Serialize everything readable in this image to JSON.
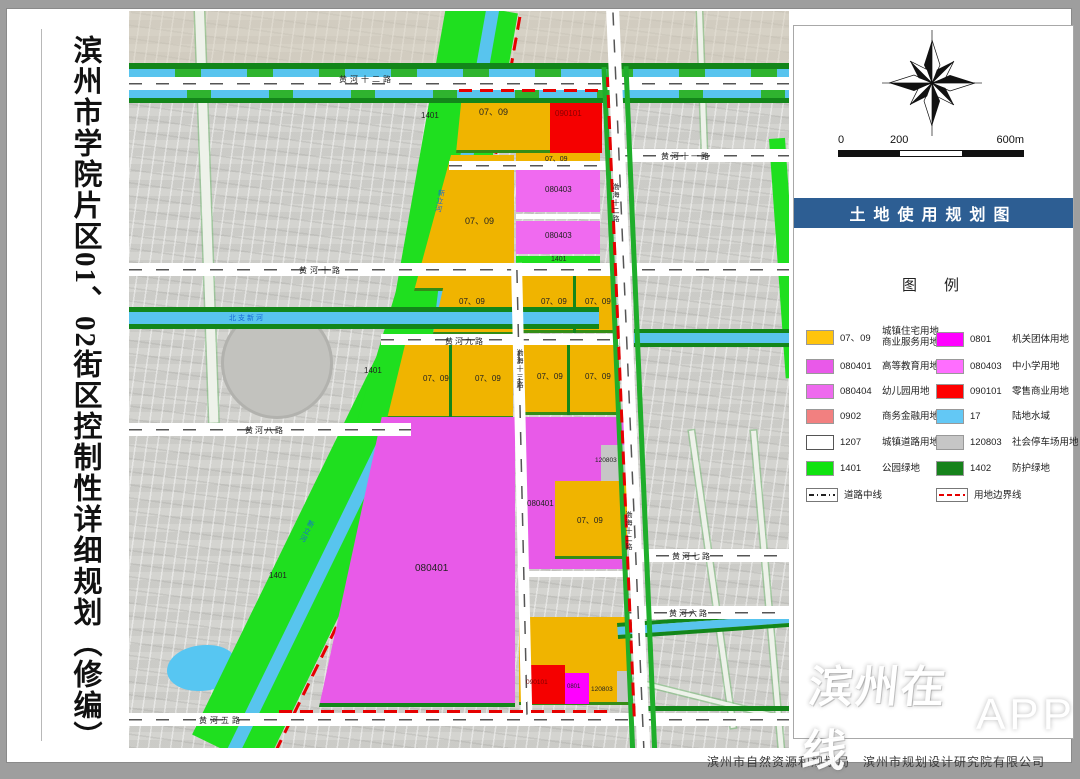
{
  "title": {
    "text": "滨州市学院片区01、02街区控制性详细规划（修编）"
  },
  "map": {
    "codes": {
      "res": "07、09",
      "gov": "0801",
      "edu": "080401",
      "school": "080403",
      "retail": "090101",
      "parking": "120803",
      "park": "1401"
    },
    "roads": {
      "hh12": "黄河十二路",
      "hh11": "黄河十一路",
      "hh10": "黄河十路",
      "hh9": "黄河九路",
      "hh8": "黄河八路",
      "hh7": "黄河七路",
      "hh6": "黄河六路",
      "hh5": "黄河五路",
      "bh12": "渤海十二路",
      "bh13": "渤海十三路"
    },
    "waters": {
      "canal": "新立河",
      "river": "北支新河"
    }
  },
  "panel": {
    "scale": {
      "t0": "0",
      "t200": "200",
      "t600": "600m"
    },
    "banner": {
      "text": "土地使用规划图",
      "color": "#2D5E93"
    },
    "legend_title": "图　例",
    "legend": [
      {
        "code": "07、09",
        "name": "城镇住宅用地",
        "name2": "商业服务用地",
        "color": "#FFC40C"
      },
      {
        "code": "0801",
        "name": "机关团体用地",
        "color": "#FF00FF"
      },
      {
        "code": "080401",
        "name": "高等教育用地",
        "color": "#E959E9"
      },
      {
        "code": "080403",
        "name": "中小学用地",
        "color": "#FF6EFF"
      },
      {
        "code": "080404",
        "name": "幼儿园用地",
        "color": "#EE6AEE"
      },
      {
        "code": "090101",
        "name": "零售商业用地",
        "color": "#FF0000"
      },
      {
        "code": "0902",
        "name": "商务金融用地",
        "color": "#F28080"
      },
      {
        "code": "17",
        "name": "陆地水域",
        "color": "#63C8F5"
      },
      {
        "code": "1207",
        "name": "城镇道路用地",
        "color": "#FFFFFF"
      },
      {
        "code": "120803",
        "name": "社会停车场用地",
        "color": "#C6C6C6"
      },
      {
        "code": "1401",
        "name": "公园绿地",
        "color": "#0FE20F"
      },
      {
        "code": "1402",
        "name": "防护绿地",
        "color": "#16821B"
      }
    ],
    "lines": [
      {
        "name": "道路中线"
      },
      {
        "name": "用地边界线"
      }
    ]
  },
  "footer": {
    "org1": "滨州市自然资源和规划局",
    "org2": "滨州市规划设计研究院有限公司"
  },
  "watermark": {
    "text": "滨州在线",
    "suffix": "APP"
  }
}
